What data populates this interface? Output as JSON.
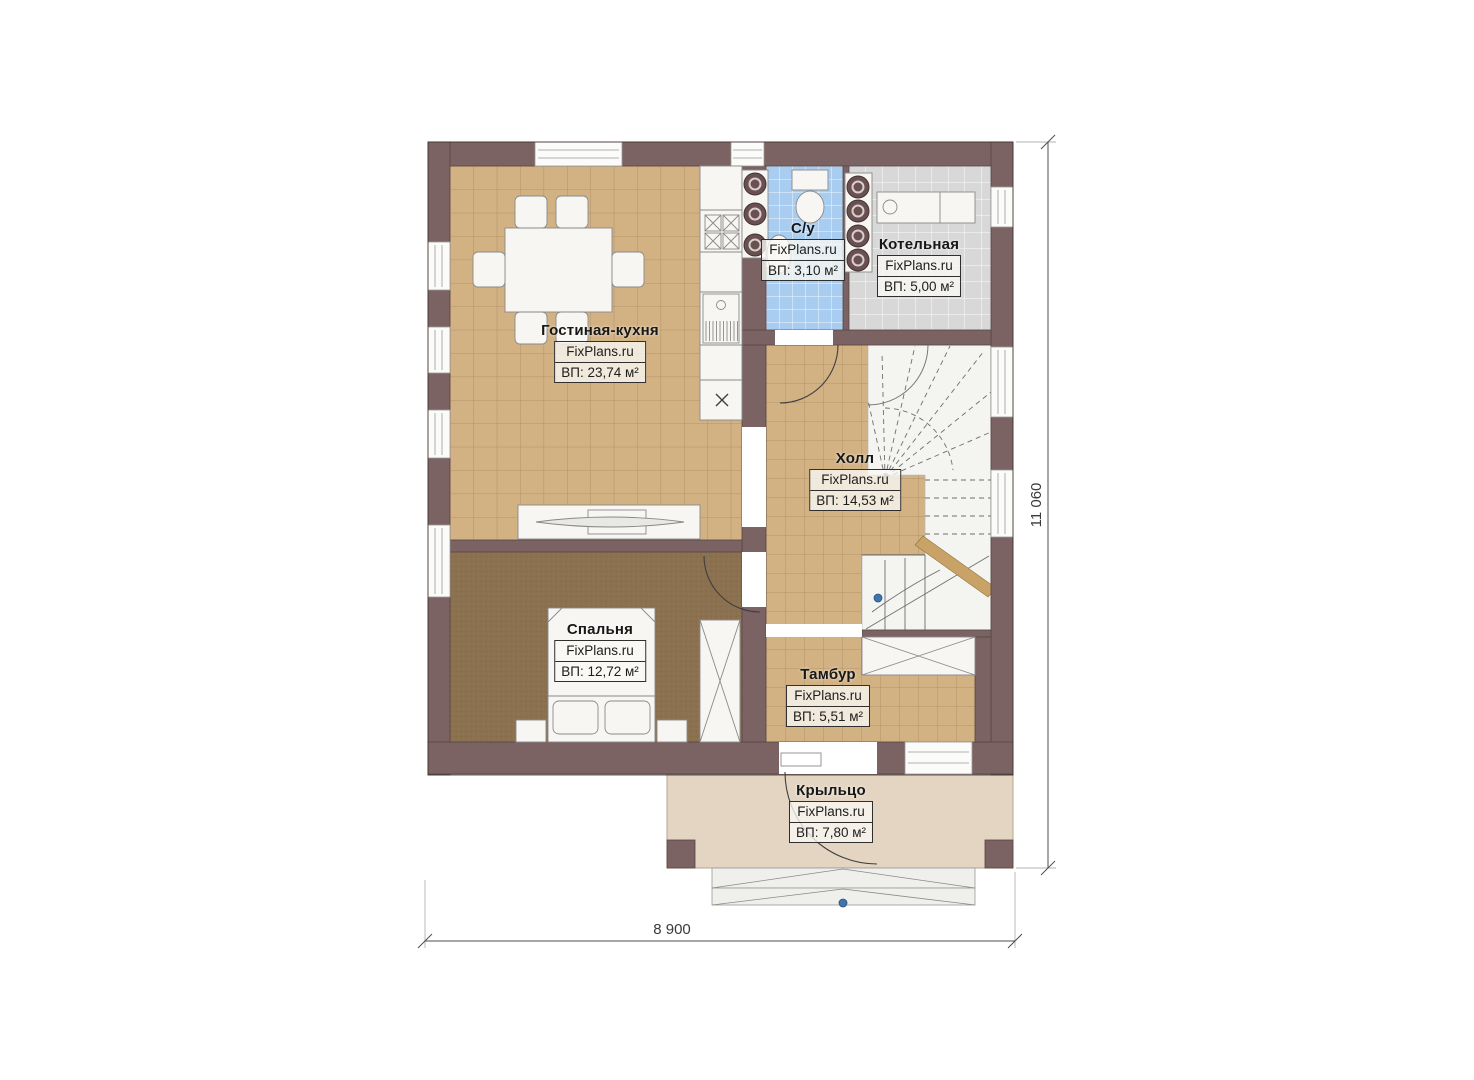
{
  "plan": {
    "title": "first-floor-plan",
    "rooms": [
      {
        "name": "Гостиная-кухня",
        "watermark": "FixPlans.ru",
        "area": "ВП: 23,74 м²"
      },
      {
        "name": "С/у",
        "watermark": "FixPlans.ru",
        "area": "ВП: 3,10 м²"
      },
      {
        "name": "Котельная",
        "watermark": "FixPlans.ru",
        "area": "ВП: 5,00 м²"
      },
      {
        "name": "Холл",
        "watermark": "FixPlans.ru",
        "area": "ВП: 14,53 м²"
      },
      {
        "name": "Спальня",
        "watermark": "FixPlans.ru",
        "area": "ВП: 12,72 м²"
      },
      {
        "name": "Тамбур",
        "watermark": "FixPlans.ru",
        "area": "ВП: 5,51 м²"
      },
      {
        "name": "Крыльцо",
        "watermark": "FixPlans.ru",
        "area": "ВП: 7,80 м²"
      }
    ],
    "dimensions": {
      "width_label": "8 900",
      "height_label": "11 060"
    },
    "colors": {
      "wall": "#7c6363",
      "tan": "#d2b183",
      "bedroom": "#8b7150",
      "bath": "#a9cdf0",
      "boiler": "#d8d8d8",
      "porch": "#e3d5c1",
      "accent": "#3f74ad"
    }
  }
}
